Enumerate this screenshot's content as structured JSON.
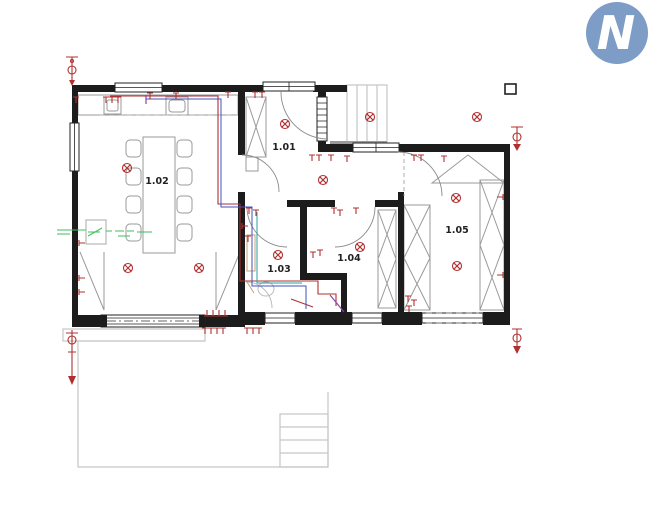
{
  "logo": {
    "letter": "N",
    "background_color": "#7d9cc6",
    "letter_color": "#ffffff"
  },
  "rooms": [
    {
      "label": "1.01"
    },
    {
      "label": "1.02"
    },
    {
      "label": "1.03"
    },
    {
      "label": "1.04"
    },
    {
      "label": "1.05"
    }
  ],
  "colors": {
    "walls": "#1c1c1c",
    "electrical_red": "#b03030",
    "plumbing_blue": "#4050c0",
    "plumbing_cyan": "#2aa0a0",
    "annotation_green": "#3fbf5f",
    "annotation_violet": "#8e44ad",
    "furniture_gray": "#9a9a9a",
    "exterior_gray": "#c6c6c6",
    "logo_blue": "#7d9cc6"
  },
  "symbols": {
    "ceiling_lights": [
      [
        127,
        168
      ],
      [
        128,
        268
      ],
      [
        199,
        268
      ],
      [
        285,
        124
      ],
      [
        323,
        180
      ],
      [
        278,
        255
      ],
      [
        360,
        247
      ],
      [
        456,
        198
      ],
      [
        457,
        266
      ],
      [
        370,
        117
      ],
      [
        477,
        117
      ]
    ],
    "wall_marks": [
      [
        76,
        97,
        0
      ],
      [
        106,
        97,
        0
      ],
      [
        112,
        97,
        0
      ],
      [
        118,
        97,
        0
      ],
      [
        150,
        93,
        0
      ],
      [
        176,
        93,
        0
      ],
      [
        228,
        92,
        0
      ],
      [
        255,
        92,
        0
      ],
      [
        262,
        92,
        0
      ],
      [
        312,
        155,
        0
      ],
      [
        319,
        155,
        0
      ],
      [
        331,
        155,
        0
      ],
      [
        347,
        156,
        0
      ],
      [
        414,
        155,
        0
      ],
      [
        421,
        155,
        0
      ],
      [
        444,
        156,
        0
      ],
      [
        503,
        197,
        90
      ],
      [
        503,
        275,
        90
      ],
      [
        79,
        243,
        270
      ],
      [
        79,
        278,
        270
      ],
      [
        79,
        292,
        270
      ],
      [
        207,
        316,
        180
      ],
      [
        213,
        316,
        180
      ],
      [
        219,
        316,
        180
      ],
      [
        225,
        316,
        180
      ],
      [
        205,
        328,
        0
      ],
      [
        211,
        328,
        0
      ],
      [
        217,
        328,
        0
      ],
      [
        223,
        328,
        0
      ],
      [
        247,
        328,
        0
      ],
      [
        253,
        328,
        0
      ],
      [
        259,
        328,
        0
      ],
      [
        408,
        296,
        0
      ],
      [
        414,
        300,
        0
      ],
      [
        409,
        306,
        0
      ],
      [
        313,
        252,
        0
      ],
      [
        320,
        250,
        0
      ],
      [
        249,
        208,
        0
      ],
      [
        256,
        210,
        0
      ],
      [
        242,
        226,
        270
      ],
      [
        248,
        236,
        0
      ],
      [
        334,
        208,
        0
      ],
      [
        340,
        210,
        0
      ],
      [
        356,
        208,
        0
      ]
    ]
  }
}
